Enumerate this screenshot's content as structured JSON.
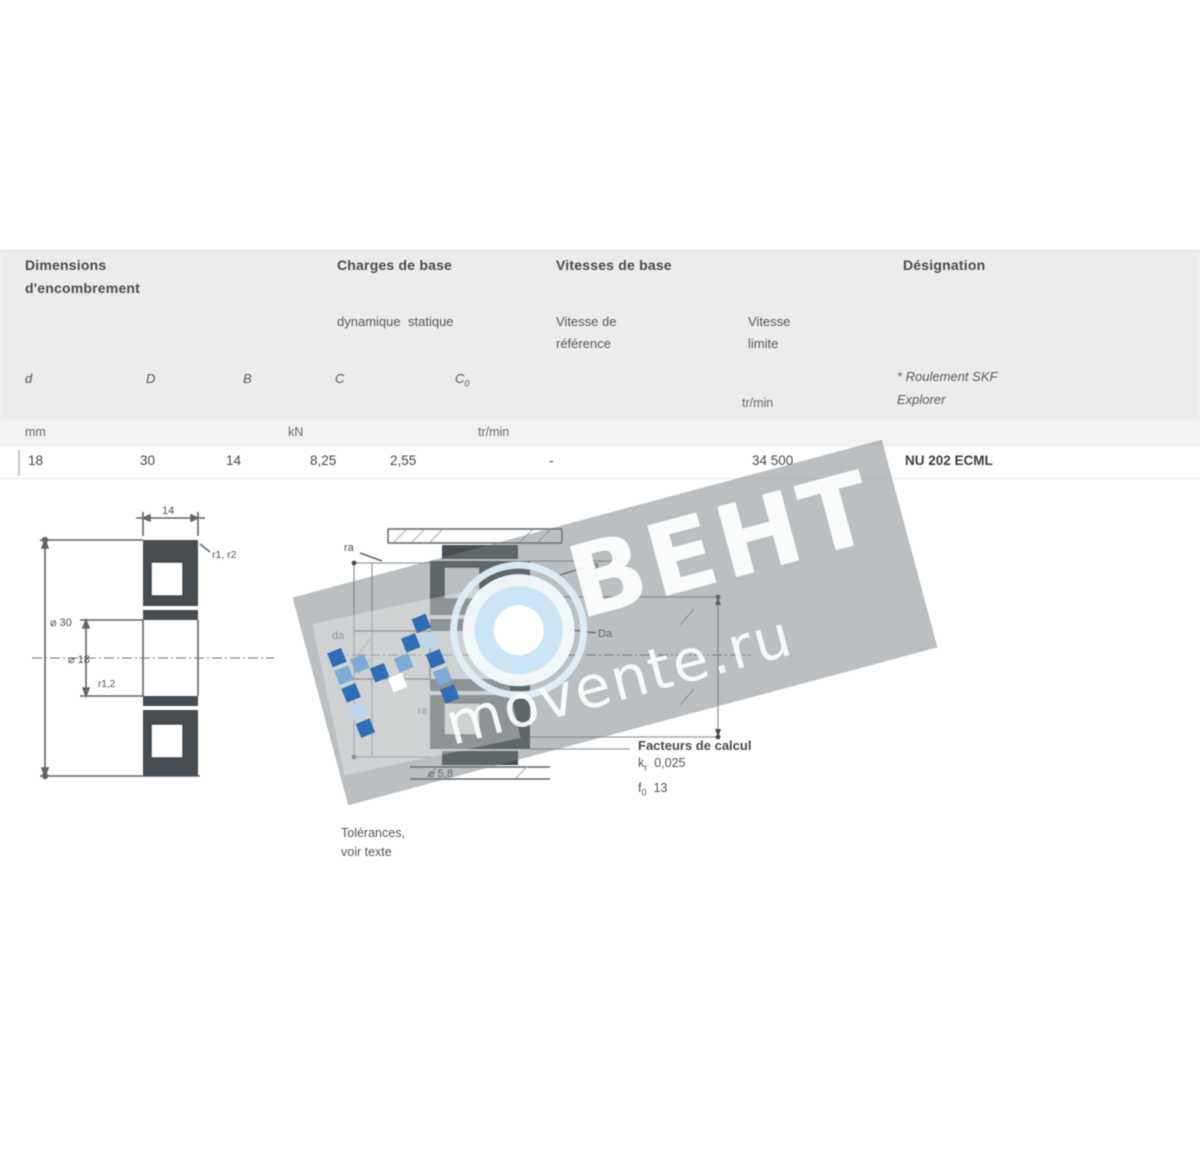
{
  "watermark": {
    "brand": "ВЕНТ",
    "domain": "movente.ru",
    "band_color": "#9fa4a7",
    "blue": "#2f6db5",
    "light_blue": "#c9e4f4"
  },
  "table": {
    "group_dimensions": {
      "line1": "Dimensions",
      "line2": "d'encombrement"
    },
    "group_loads": {
      "title": "Charges de base",
      "sub_dynamic": "dynamique",
      "sub_static": "statique",
      "sym_c": "C",
      "sym_c0_base": "C",
      "sym_c0_sub": "0"
    },
    "group_speeds": {
      "title": "Vitesses de base",
      "ref_line1": "Vitesse de",
      "ref_line2": "référence",
      "lim_line1": "Vitesse",
      "lim_line2": "limite",
      "lim_unit": "tr/min"
    },
    "group_designation": {
      "title": "Désignation",
      "note1": "* Roulement SKF",
      "note2": "Explorer"
    },
    "symbols": {
      "d": "d",
      "D": "D",
      "B": "B"
    },
    "units": {
      "mm": "mm",
      "kn": "kN",
      "rpm": "tr/min"
    },
    "row": {
      "d": "18",
      "D": "30",
      "B": "14",
      "c": "8,25",
      "c0": "2,55",
      "v_ref": "-",
      "v_lim": "34 500",
      "designation": "NU 202 ECML"
    }
  },
  "figures": {
    "left": {
      "b_value": "14",
      "od": "⌀ 30",
      "bore": "⌀ 18",
      "fillet_top": "r1, r2",
      "fillet_bottom": "r1,2"
    },
    "middle": {
      "ra_top": "ra",
      "da_left": "da",
      "ra_right": "ra",
      "da_right": "Da",
      "ra_small": "ra",
      "bottom_note": "⌀ 5,8"
    },
    "tolerances": {
      "line1": "Tolérances,",
      "line2": "voir texte"
    },
    "factors": {
      "title": "Facteurs de calcul",
      "f1_sym": "k",
      "f1_sub": "r",
      "f1_val": "0,025",
      "f2_sym": "f",
      "f2_sub": "0",
      "f2_val": "13"
    }
  }
}
